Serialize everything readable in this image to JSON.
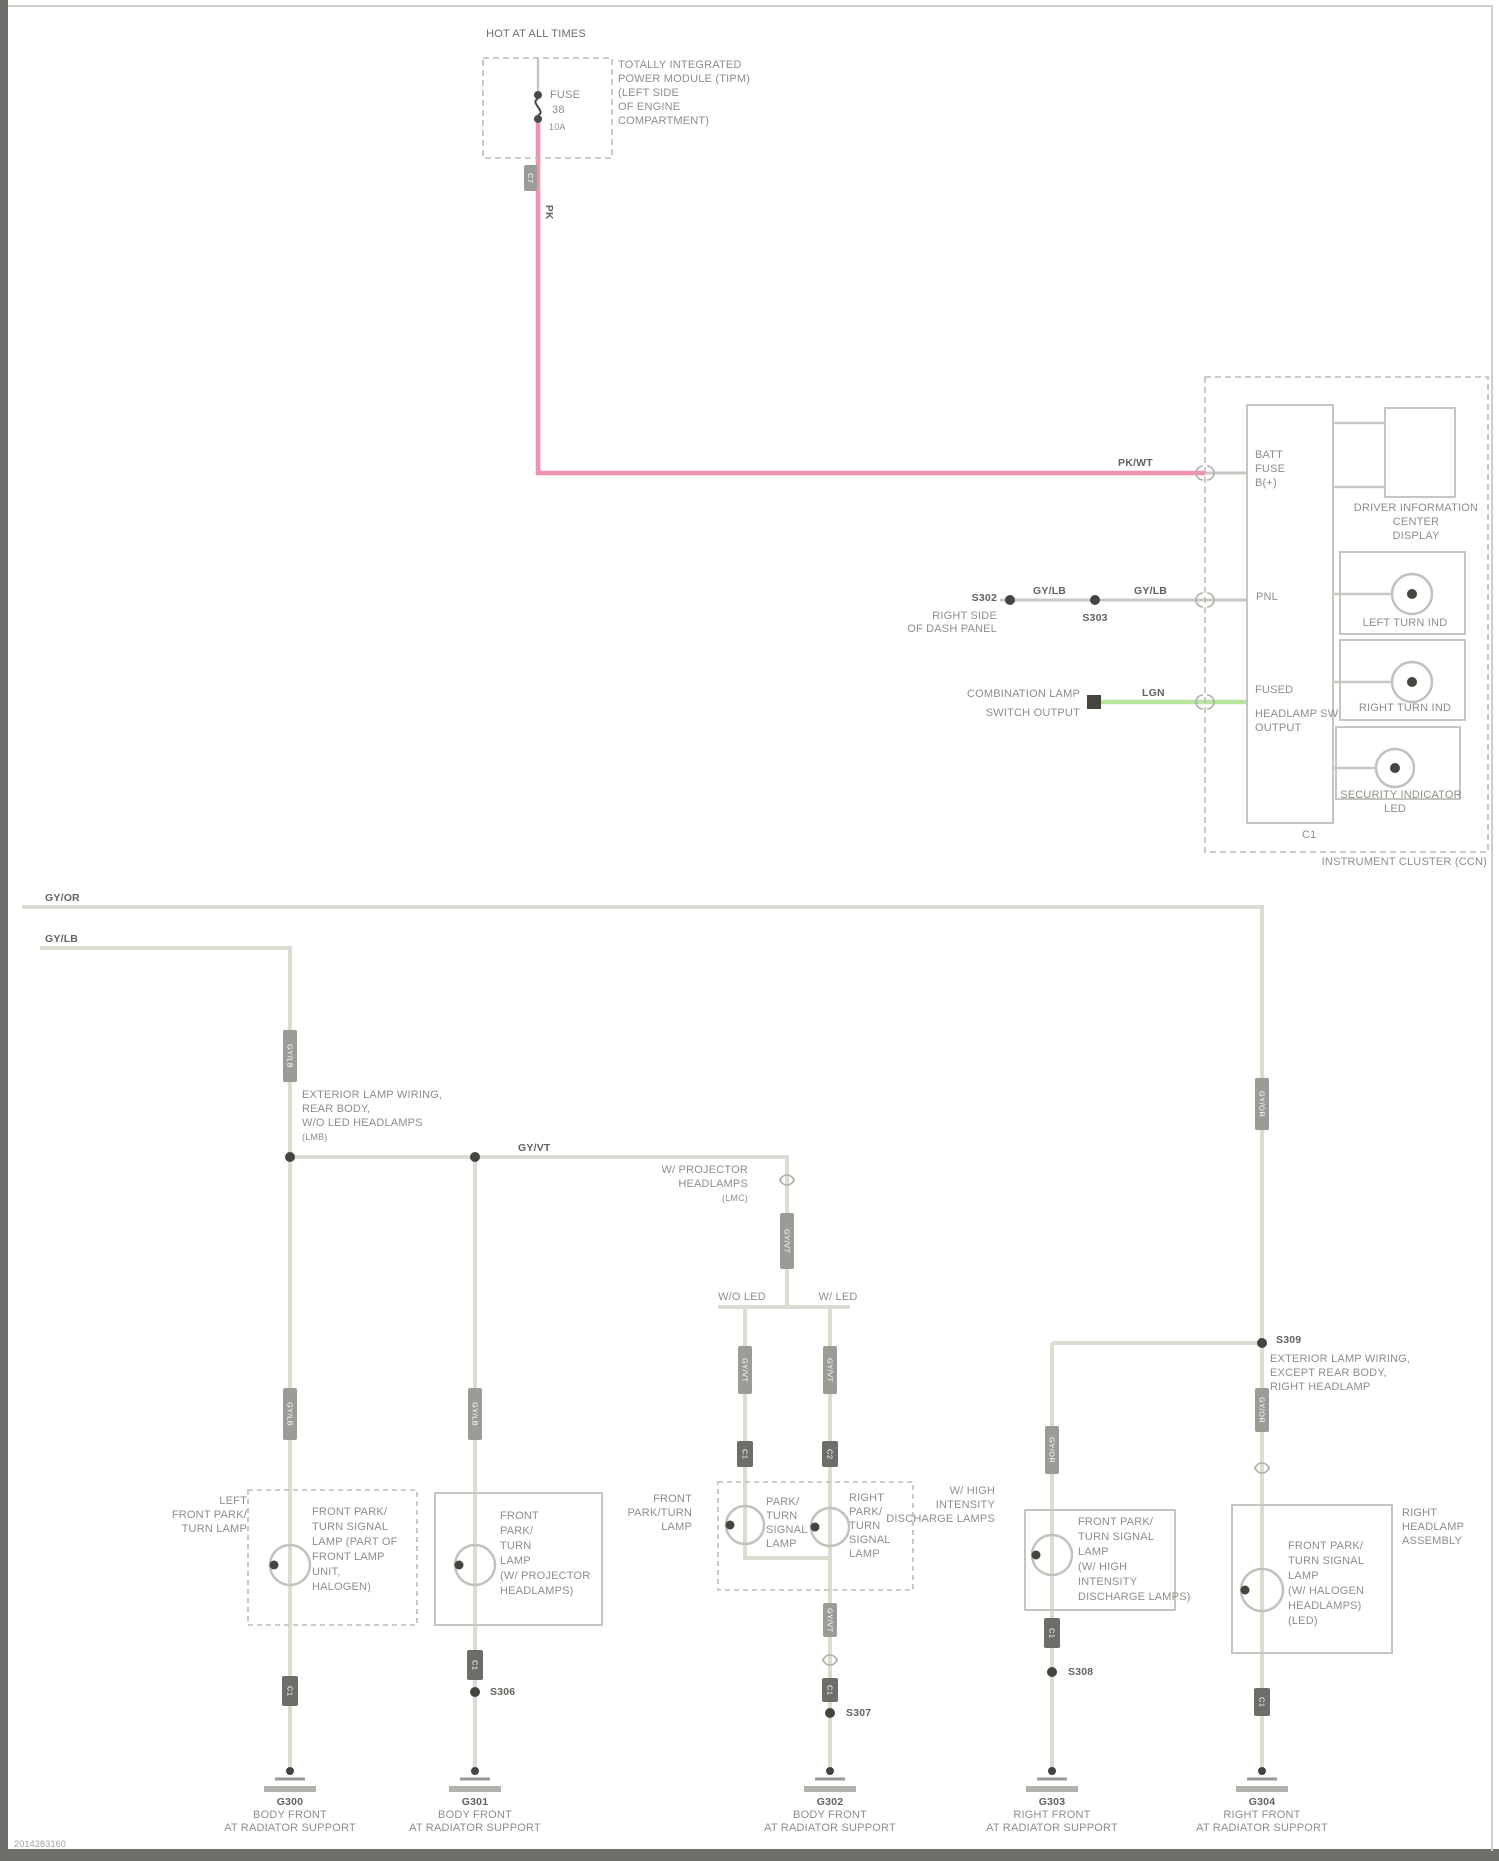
{
  "page": {
    "footer": "2014283160"
  },
  "colors": {
    "wire": "#dcdcd3",
    "battery_feed": "#f293ad",
    "switch_signal": "#b7e59d",
    "box_stroke": "#c6c6c0",
    "text": "#8e8e88",
    "dark_marks": "#45453f"
  },
  "fuse_block": {
    "hot": "HOT AT ALL TIMES",
    "module": [
      "TOTALLY INTEGRATED",
      "POWER MODULE (TIPM)",
      "(LEFT SIDE",
      "OF ENGINE",
      "COMPARTMENT)"
    ],
    "fuse": [
      "FUSE",
      "38",
      "10A"
    ]
  },
  "batt_wire": {
    "v_code": "PK",
    "h_code": "PK/WT"
  },
  "cluster": {
    "name": "INSTRUMENT CLUSTER (CCN)",
    "pin1": [
      "BATT",
      "FUSE",
      "B(+)"
    ],
    "pin2": "PNL",
    "pin3": [
      "FUSED",
      "HEADLAMP SW",
      "OUTPUT"
    ],
    "conn_bottom": "C1",
    "display": [
      "DRIVER INFORMATION",
      "CENTER",
      "DISPLAY"
    ],
    "ind_a": "LEFT TURN IND",
    "ind_b": "RIGHT TURN IND",
    "ind_c": "SECURITY INDICATOR",
    "ind_c2": "LED"
  },
  "panel_wire": {
    "from": "S302",
    "note": [
      "RIGHT SIDE",
      "OF DASH PANEL"
    ],
    "code_a": "GY/LB",
    "splice": "S303",
    "code_b": "GY/LB"
  },
  "switch_wire": {
    "note": [
      "COMBINATION LAMP",
      "SWITCH OUTPUT"
    ],
    "code": "LGN"
  },
  "feed_a": {
    "code": "GY/OR"
  },
  "feed_b": {
    "code": "GY/LB"
  },
  "branch": {
    "note1": [
      "EXTERIOR LAMP WIRING,",
      "REAR BODY,",
      "W/O LED HEADLAMPS",
      "(LMB)"
    ],
    "code_h": "GY/VT",
    "note2": [
      "W/ PROJECTOR",
      "HEADLAMPS",
      "(LMC)"
    ],
    "split_left": "W/O LED",
    "split_right": "W/ LED",
    "note3": [
      "EXTERIOR LAMP WIRING,",
      "EXCEPT REAR BODY,",
      "RIGHT HEADLAMP"
    ],
    "splice_top": "S309"
  },
  "tags": {
    "fuse": "C7",
    "w290": "GY/LB",
    "w1262": "GY/OR",
    "w787": "GY/VT",
    "c3a": "GY/VT",
    "c3b": "GY/VT",
    "c3a_conn": "C1",
    "c3b_conn": "C2",
    "c1mid": "GY/LB",
    "c2mid": "GY/LB",
    "c4mid": "GY/OR",
    "c5mid": "GY/OR",
    "c1low": "C1",
    "c2low": "C1",
    "c3low": "GY/VT",
    "c3low_conn": "C1",
    "c4low": "C1",
    "c5low": "C1"
  },
  "circuit1": {
    "left": [
      "LEFT",
      "FRONT PARK/",
      "TURN LAMP"
    ],
    "inside": [
      "FRONT PARK/",
      "TURN SIGNAL",
      "LAMP (PART OF",
      "FRONT LAMP",
      "UNIT,",
      "HALOGEN)"
    ]
  },
  "circuit2": {
    "inside": [
      "FRONT",
      "PARK/",
      "TURN",
      "LAMP",
      "(W/ PROJECTOR",
      "HEADLAMPS)"
    ],
    "splice": "S306"
  },
  "circuit3": {
    "left": [
      "FRONT",
      "PARK/TURN",
      "LAMP"
    ],
    "lamp_l": [
      "PARK/",
      "TURN",
      "SIGNAL",
      "LAMP"
    ],
    "lamp_r": [
      "RIGHT",
      "PARK/",
      "TURN",
      "SIGNAL",
      "LAMP"
    ],
    "splice": "S307"
  },
  "circuit4": {
    "left": [
      "W/ HIGH",
      "INTENSITY",
      "DISCHARGE LAMPS"
    ],
    "inside": [
      "FRONT PARK/",
      "TURN SIGNAL",
      "LAMP",
      "(W/ HIGH",
      "INTENSITY",
      "DISCHARGE LAMPS)"
    ],
    "splice": "S308"
  },
  "circuit5": {
    "right": [
      "RIGHT",
      "HEADLAMP",
      "ASSEMBLY"
    ],
    "inside": [
      "FRONT PARK/",
      "TURN SIGNAL",
      "LAMP",
      "(W/ HALOGEN",
      "HEADLAMPS)",
      "(LED)"
    ]
  },
  "grounds": {
    "g1": [
      "G300",
      "BODY FRONT",
      "AT RADIATOR SUPPORT"
    ],
    "g2": [
      "G301",
      "BODY FRONT",
      "AT RADIATOR SUPPORT"
    ],
    "g3": [
      "G302",
      "BODY FRONT",
      "AT RADIATOR SUPPORT"
    ],
    "g4": [
      "G303",
      "RIGHT FRONT",
      "AT RADIATOR SUPPORT"
    ],
    "g5": [
      "G304",
      "RIGHT FRONT",
      "AT RADIATOR SUPPORT"
    ]
  }
}
